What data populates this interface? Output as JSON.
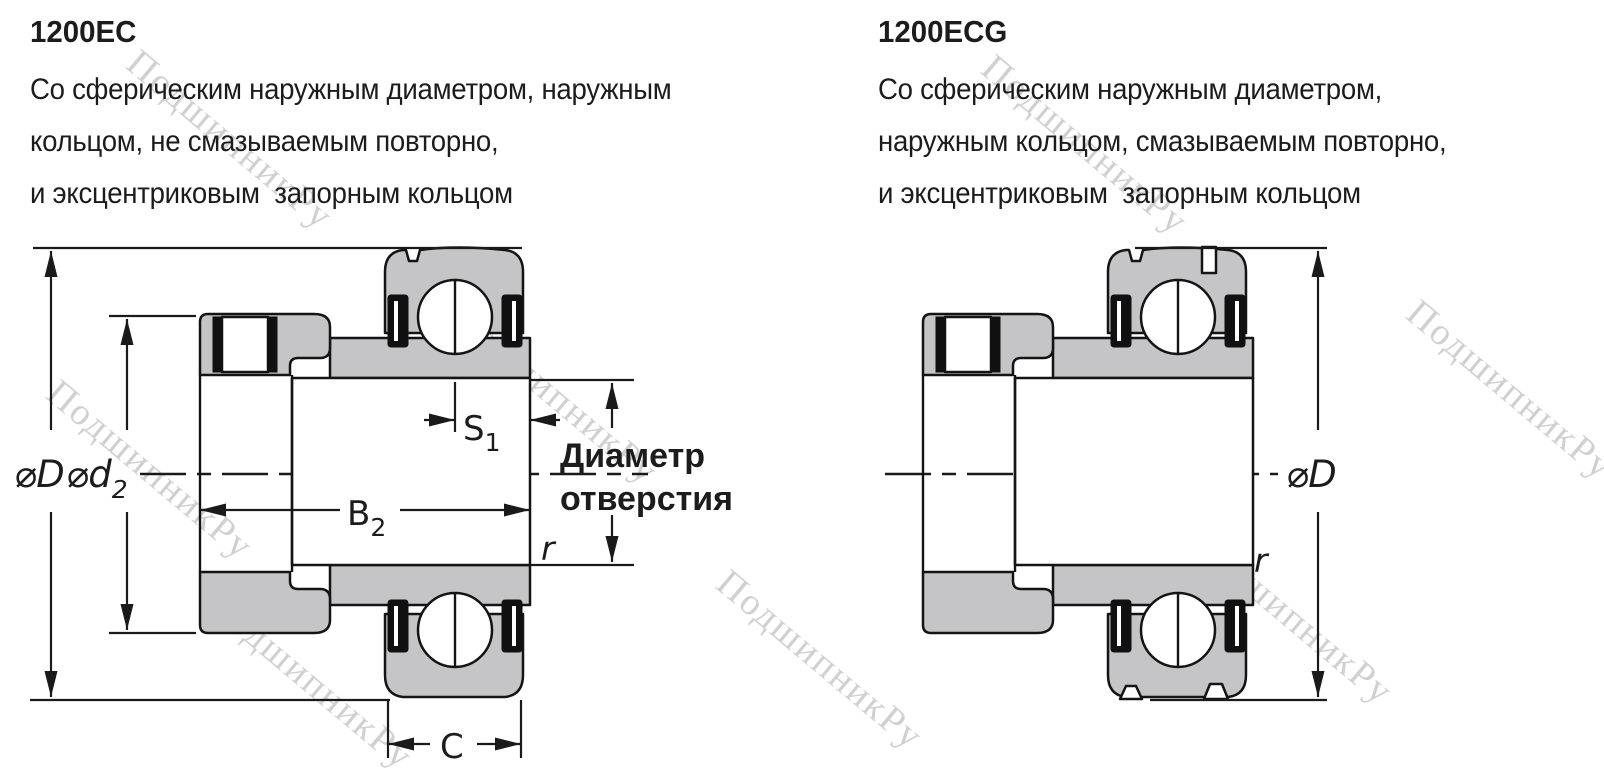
{
  "colors": {
    "background": "#ffffff",
    "bearing_fill": "#c5c5c7",
    "outline": "#141414",
    "dim_line": "#1a1a1a",
    "text": "#1c1c1c",
    "watermark": "#c8c8c8"
  },
  "watermark": {
    "text": "ПодшипникРу",
    "angle_deg": 40,
    "positions": [
      {
        "x": 230,
        "y": 140
      },
      {
        "x": 1085,
        "y": 145
      },
      {
        "x": 150,
        "y": 470
      },
      {
        "x": 555,
        "y": 395
      },
      {
        "x": 310,
        "y": 680
      },
      {
        "x": 820,
        "y": 660
      },
      {
        "x": 1510,
        "y": 390
      },
      {
        "x": 1290,
        "y": 615
      }
    ]
  },
  "products": [
    {
      "model": "1200EC",
      "description_lines": [
        "Со сферическим наружным диаметром, наружным",
        "кольцом, не смазываемым повторно,",
        "и эксцентриковым  запорным кольцом"
      ],
      "dimensions": {
        "outer_diameter": {
          "symbol": "⌀",
          "letter": "D"
        },
        "collar_diameter": {
          "symbol": "⌀",
          "letter": "d",
          "sub": "2"
        },
        "inner_ring_width": {
          "letter": "B",
          "sub": "2"
        },
        "locating_width": {
          "letter": "S",
          "sub": "1"
        },
        "outer_ring_width": {
          "letter": "C"
        },
        "fillet_radius": {
          "letter": "r"
        },
        "bore_label": {
          "line1": "Диаметр",
          "line2": "отверстия"
        }
      }
    },
    {
      "model": "1200ECG",
      "description_lines": [
        "Со сферическим наружным диаметром,",
        "наружным кольцом, смазываемым повторно,",
        "и эксцентриковым  запорным кольцом"
      ],
      "dimensions": {
        "outer_diameter": {
          "symbol": "⌀",
          "letter": "D"
        },
        "fillet_radius": {
          "letter": "r"
        }
      }
    }
  ]
}
